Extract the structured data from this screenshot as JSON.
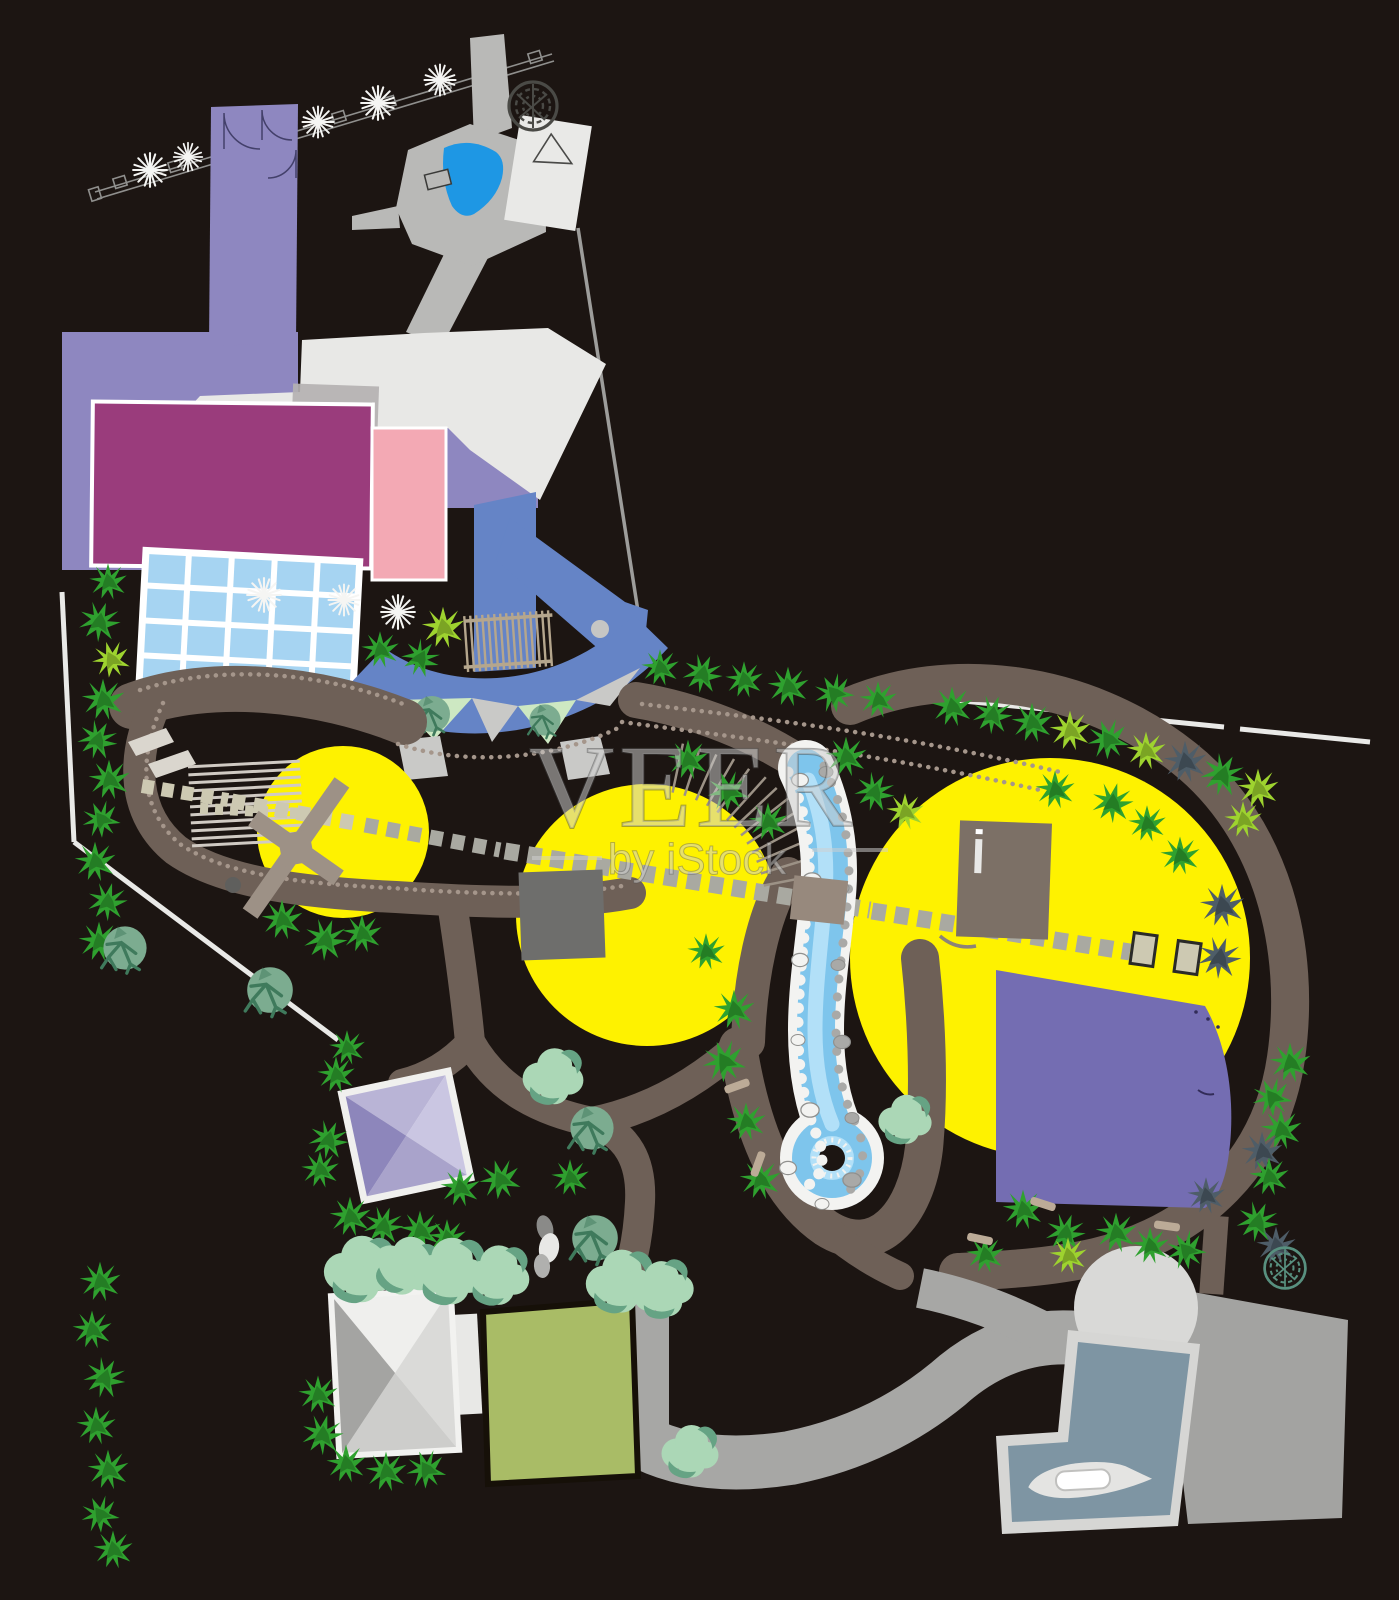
{
  "watermark": {
    "title": "VEER",
    "subtitle": "by iStock"
  },
  "palette": {
    "bg": "#1c1512",
    "boundary": "#e9e9e7",
    "lineGray": "#9d9d9b",
    "fence": "#8f8f8d",
    "spark": "#f5f5f3",
    "lavender": "#8e87c0",
    "magenta": "#9a3c7c",
    "pink": "#f3a9b4",
    "roofWhite": "#e8e8e6",
    "overlayGray": "#b4b1b2",
    "glassBlue": "#a6d4f2",
    "mullion": "#ffffff",
    "plazaBlue": "#6584c6",
    "wedgeGreen": "#cde8c2",
    "wedgeGray": "#c9c9c7",
    "plazaDot": "#c6c6c4",
    "pondBlue": "#1e97e4",
    "pondRim": "#b9b9b7",
    "buildingWhite": "#e9e9e7",
    "scribble": "#4a4a46",
    "scribbleTeal": "#58907f",
    "yellow": "#fef200",
    "pathTaupe": "#6e6057",
    "bead": "#a5968b",
    "stoneGray": "#a9a9a1",
    "stoneBeige": "#cdc9b2",
    "railGray": "#d0cac3",
    "stepLight": "#dad6ce",
    "riverBlue": "#7ec5ec",
    "riverLight": "#b2e0f8",
    "rockWhite": "#f3f3f1",
    "rockGray": "#a9a9a7",
    "purpleRect": "#746db2",
    "bldTaupe": "#7c7066",
    "bldGray": "#6e6e6c",
    "windmill": "#9d9186",
    "treeGreen": "#2fa12f",
    "treeLime": "#9ed32f",
    "treeSlate": "#4e5d68",
    "treeSage": "#7cac90",
    "sageBranch": "#3f7a5c",
    "treeMint": "#abd7b6",
    "mintShadow": "#66a384",
    "fenceTan": "#b5a68d",
    "lawn": "#a9bc66",
    "roadGray": "#a7a7a5",
    "plazaGray": "#a3a3a1",
    "poolSlate": "#7e95a3",
    "poolBorder": "#d6d6d4",
    "domeGray": "#d9d9d7",
    "boatHull": "#e4e4e2",
    "boatCabin": "#ffffff",
    "benchTan": "#bcab97",
    "bridge": "#97897d",
    "watermark": "rgba(208,208,208,0.52)",
    "watermarkLine": "rgba(208,208,208,0.52)"
  }
}
